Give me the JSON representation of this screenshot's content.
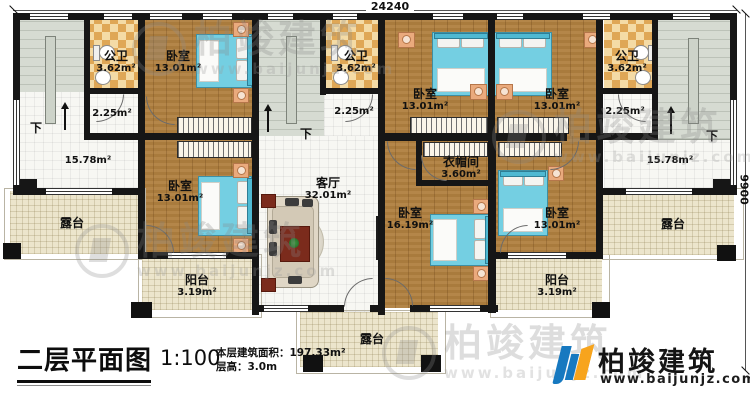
{
  "dimensions": {
    "top": "24240",
    "right": "9900"
  },
  "stairs": {
    "down": "下"
  },
  "rooms": {
    "bath_left": {
      "name": "公卫",
      "area": "3.62m²"
    },
    "bath_mid": {
      "name": "公卫",
      "area": "3.62m²"
    },
    "bath_right": {
      "name": "公卫",
      "area": "3.62m²"
    },
    "bed_top_left": {
      "name": "卧室",
      "area": "13.01m²"
    },
    "bed_top_center": {
      "name": "卧室",
      "area": "13.01m²"
    },
    "bed_top_right": {
      "name": "卧室",
      "area": "13.01m²"
    },
    "bed_mid_left": {
      "name": "卧室",
      "area": "13.01m²"
    },
    "bed_mid_right": {
      "name": "卧室",
      "area": "13.01m²"
    },
    "bed_master": {
      "name": "卧室",
      "area": "16.19m²"
    },
    "living": {
      "name": "客厅",
      "area": "32.01m²"
    },
    "cloakroom": {
      "name": "衣帽间",
      "area": "3.60m²"
    },
    "hall_left": {
      "area": "15.78m²"
    },
    "hall_right": {
      "area": "15.78m²"
    },
    "corridor_left": {
      "area": "2.25m²"
    },
    "corridor_mid": {
      "area": "2.25m²"
    },
    "corridor_right": {
      "area": "2.25m²"
    },
    "terrace_left": {
      "name": "露台"
    },
    "terrace_right": {
      "name": "露台"
    },
    "terrace_center": {
      "name": "露台"
    },
    "balcony_left": {
      "name": "阳台",
      "area": "3.19m²"
    },
    "balcony_right": {
      "name": "阳台",
      "area": "3.19m²"
    }
  },
  "title_block": {
    "title": "二层平面图",
    "scale": "1:100",
    "area_line": "本层建筑面积：197.33m²",
    "height_line": "层高：3.0m"
  },
  "brand": {
    "name": "柏竣建筑",
    "url": "www.baijunjz.com"
  },
  "watermark": {
    "name": "柏竣建筑",
    "url": "www.baijunjz.com"
  },
  "colors": {
    "wall": "#161616",
    "wood": "#b0803f",
    "bed": "#74cfe2",
    "terrace": "#ece5cc",
    "checker_light": "#f4dba6",
    "checker_dark": "#dfa756",
    "stair": "#d6dbd2",
    "brand_blue": "#1779c0",
    "brand_orange": "#f7a41d"
  }
}
